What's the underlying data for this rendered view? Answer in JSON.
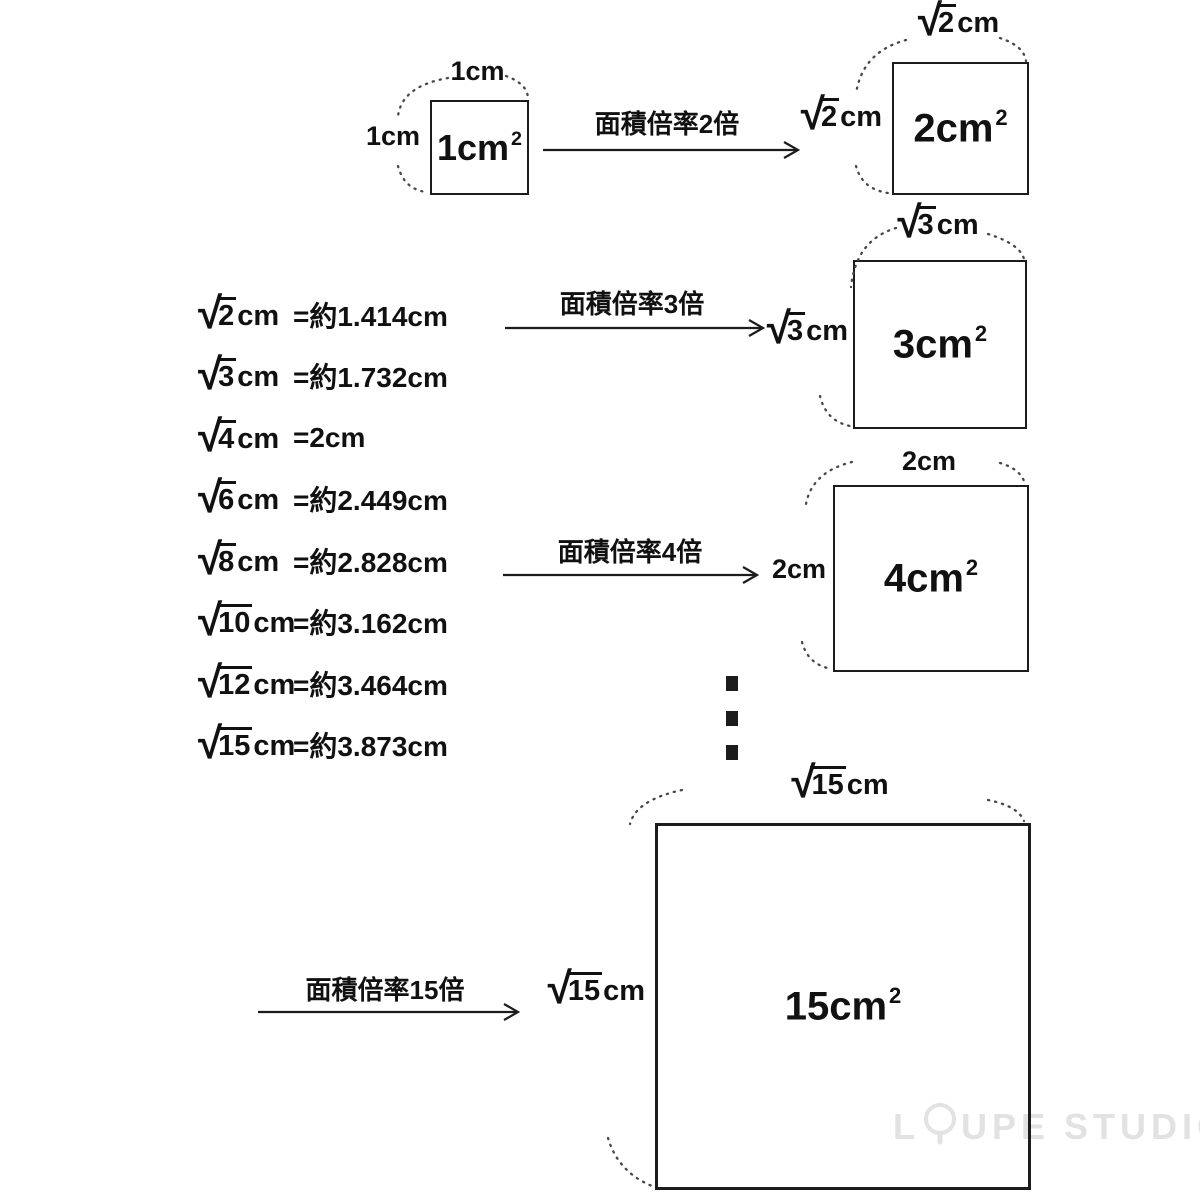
{
  "colors": {
    "ink": "#111111",
    "background": "#ffffff",
    "watermark": "#e2e2e2"
  },
  "squares": {
    "s1": {
      "area": "1cm",
      "sup": "2",
      "top_label": "1cm",
      "left_label": "1cm"
    },
    "s2": {
      "area": "2cm",
      "sup": "2",
      "top_radicand": "2",
      "top_unit": "cm",
      "left_radicand": "2",
      "left_unit": "cm"
    },
    "s3": {
      "area": "3cm",
      "sup": "2",
      "top_radicand": "3",
      "top_unit": "cm",
      "left_radicand": "3",
      "left_unit": "cm"
    },
    "s4": {
      "area": "4cm",
      "sup": "2",
      "top_label": "2cm",
      "left_label": "2cm"
    },
    "s5": {
      "area": "15cm",
      "sup": "2",
      "top_radicand": "15",
      "top_unit": "cm",
      "left_radicand": "15",
      "left_unit": "cm"
    }
  },
  "arrows": {
    "a1": {
      "label": "面積倍率2倍"
    },
    "a2": {
      "label": "面積倍率3倍"
    },
    "a3": {
      "label": "面積倍率4倍"
    },
    "a4": {
      "label": "面積倍率15倍"
    }
  },
  "equations": [
    {
      "radicand": "2",
      "unit": "cm",
      "rhs": "=約1.414cm"
    },
    {
      "radicand": "3",
      "unit": "cm",
      "rhs": "=約1.732cm"
    },
    {
      "radicand": "4",
      "unit": "cm",
      "rhs": "=2cm"
    },
    {
      "radicand": "6",
      "unit": "cm",
      "rhs": "=約2.449cm"
    },
    {
      "radicand": "8",
      "unit": "cm",
      "rhs": "=約2.828cm"
    },
    {
      "radicand": "10",
      "unit": "cm",
      "rhs": "=約3.162cm"
    },
    {
      "radicand": "12",
      "unit": "cm",
      "rhs": "=約3.464cm"
    },
    {
      "radicand": "15",
      "unit": "cm",
      "rhs": "=約3.873cm"
    }
  ],
  "watermark": {
    "prefix": "L",
    "suffix_mid": "UPE",
    "suffix_end": "STUDIO"
  }
}
